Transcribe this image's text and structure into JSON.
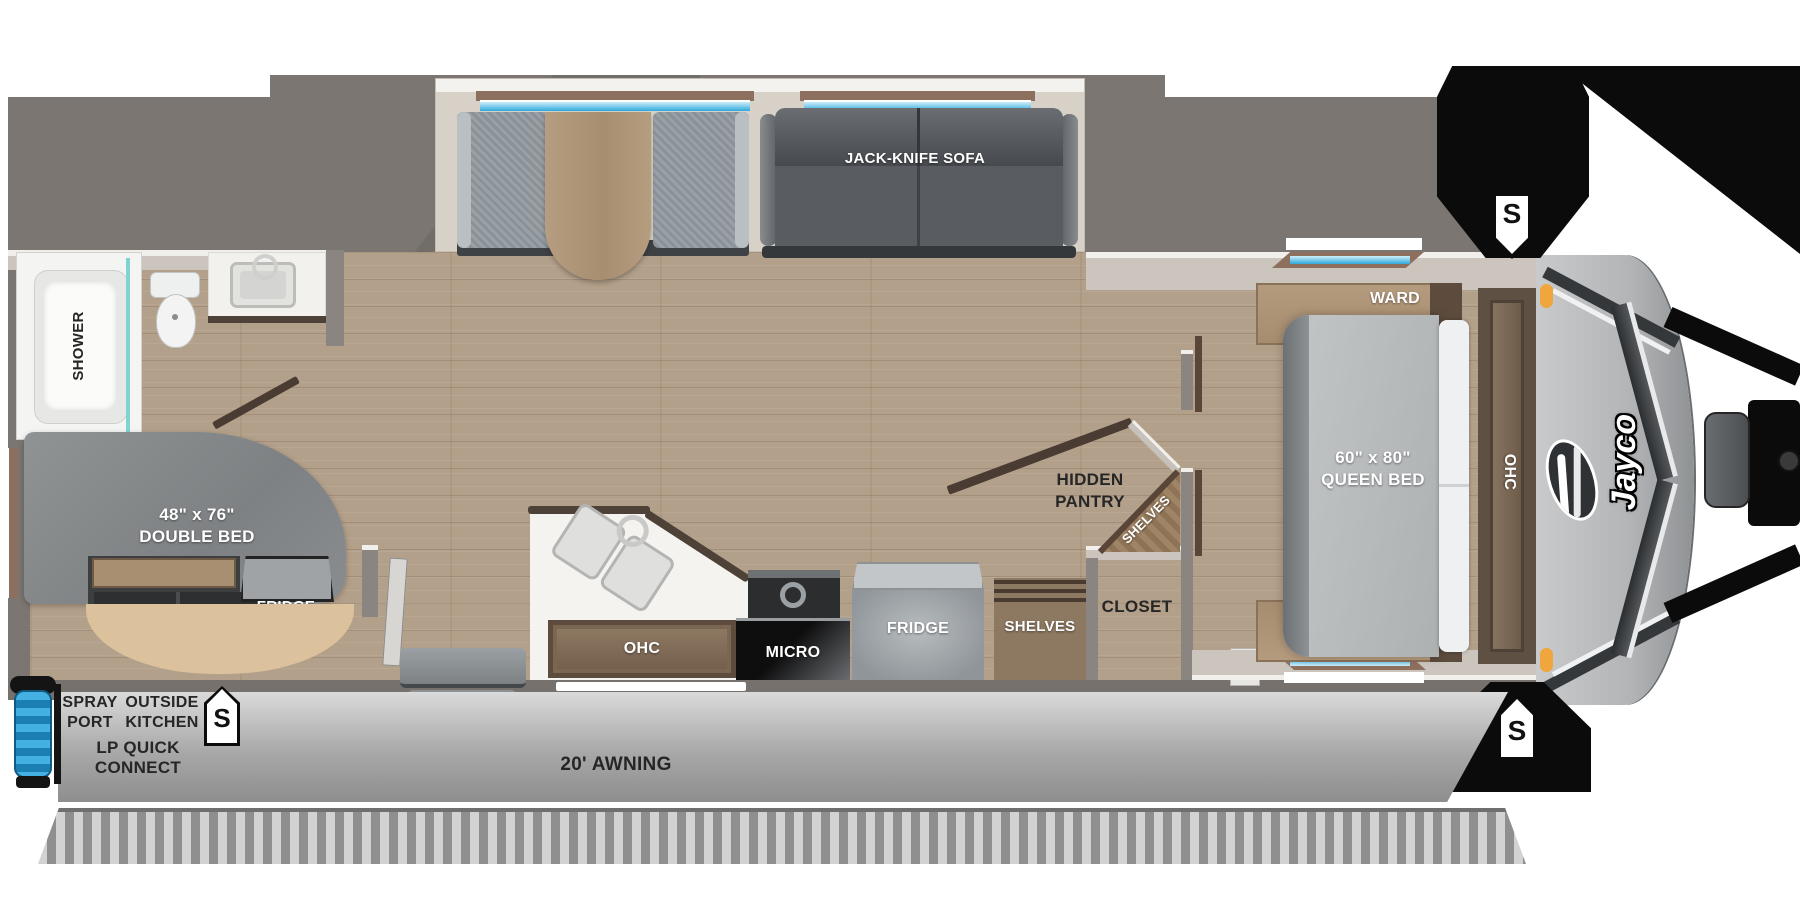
{
  "plan": {
    "brand": "Jayco",
    "awning_label": "20' AWNING",
    "stab_jack": "S"
  },
  "slideout": {
    "sofa_label": "JACK-KNIFE SOFA"
  },
  "bathroom": {
    "shower": "SHOWER"
  },
  "bedroom": {
    "ward_top": "WARD",
    "ward_bottom": "WARD",
    "bed_size": "60\" x 80\"",
    "bed_type": "QUEEN BED",
    "ohc": "OHC"
  },
  "pantry": {
    "line1": "HIDDEN",
    "line2": "PANTRY",
    "corner_shelves": "SHELVES"
  },
  "closet": {
    "label": "CLOSET",
    "shelves": "SHELVES"
  },
  "kitchen": {
    "ohc": "OHC",
    "micro": "MICRO",
    "fridge": "FRIDGE"
  },
  "rear_bed": {
    "size": "48\" x 76\"",
    "type": "DOUBLE BED",
    "fridge": "FRIDGE"
  },
  "exterior": {
    "spray1": "SPRAY",
    "spray2": "PORT",
    "ok1": "OUTSIDE",
    "ok2": "KITCHEN",
    "lp1": "LP QUICK",
    "lp2": "CONNECT"
  },
  "colors": {
    "floor": "#b3a08a",
    "shell_gray": "#7b7672",
    "window_blue": "#46b8e8",
    "accent_black": "#0b0b0b",
    "awning_gray": "#b9b9b9",
    "marker_orange": "#f0a63c"
  }
}
